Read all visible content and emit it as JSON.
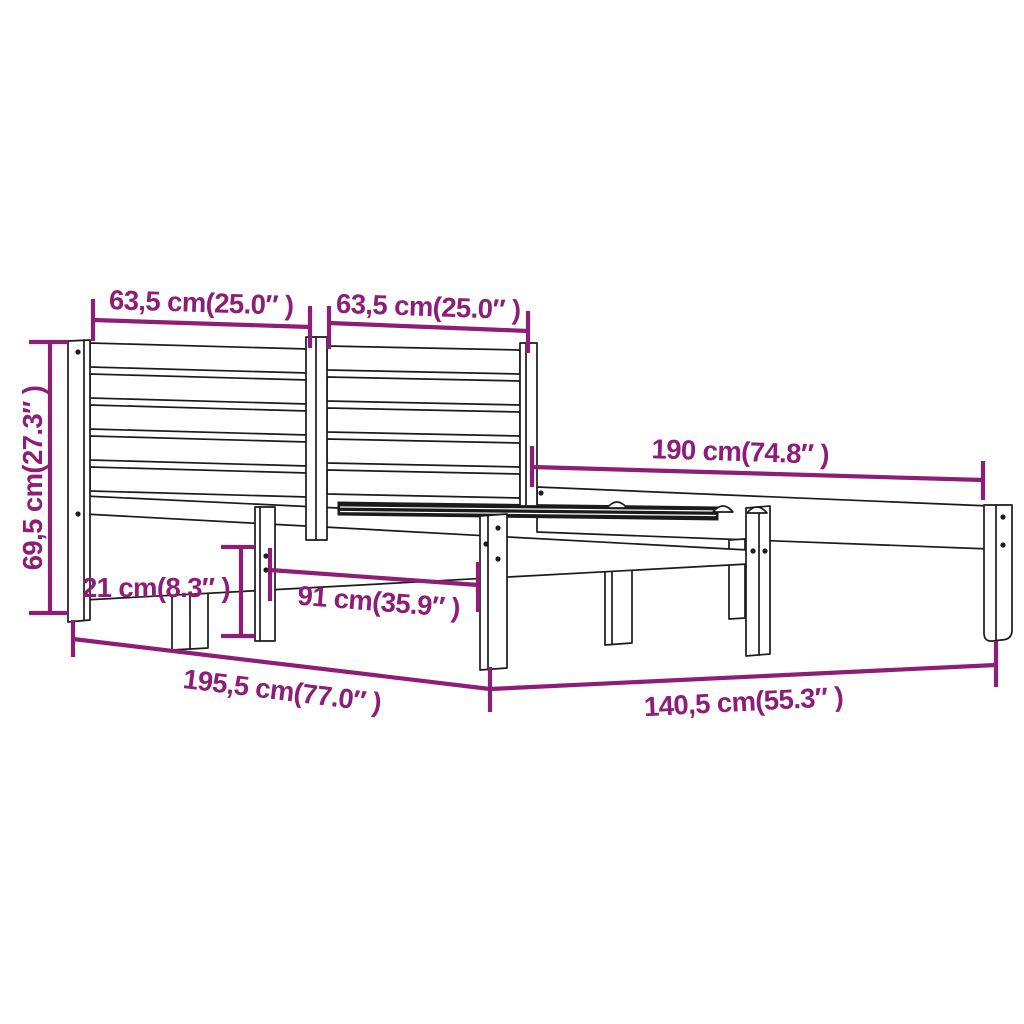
{
  "diagram": {
    "type": "product-dimension-diagram",
    "subject": "Wooden bed frame with slatted headboard",
    "background": "#ffffff",
    "colors": {
      "dimension": "#8d1d77",
      "line_art": "#1b1b1b"
    },
    "dimensions": [
      {
        "id": "headboard-left-panel-width",
        "label": "63,5 cm(25.0″ )"
      },
      {
        "id": "headboard-right-panel-width",
        "label": "63,5 cm(25.0″ )"
      },
      {
        "id": "headboard-height",
        "label": "69,5 cm(27.3″ )"
      },
      {
        "id": "frame-side-length",
        "label": "190 cm(74.8″ )"
      },
      {
        "id": "frame-rail-height",
        "label": "21 cm(8.3″ )"
      },
      {
        "id": "leg-spacing",
        "label": "91 cm(35.9″ )"
      },
      {
        "id": "total-length",
        "label": "195,5 cm(77.0″ )"
      },
      {
        "id": "total-width",
        "label": "140,5 cm(55.3″ )"
      }
    ]
  }
}
